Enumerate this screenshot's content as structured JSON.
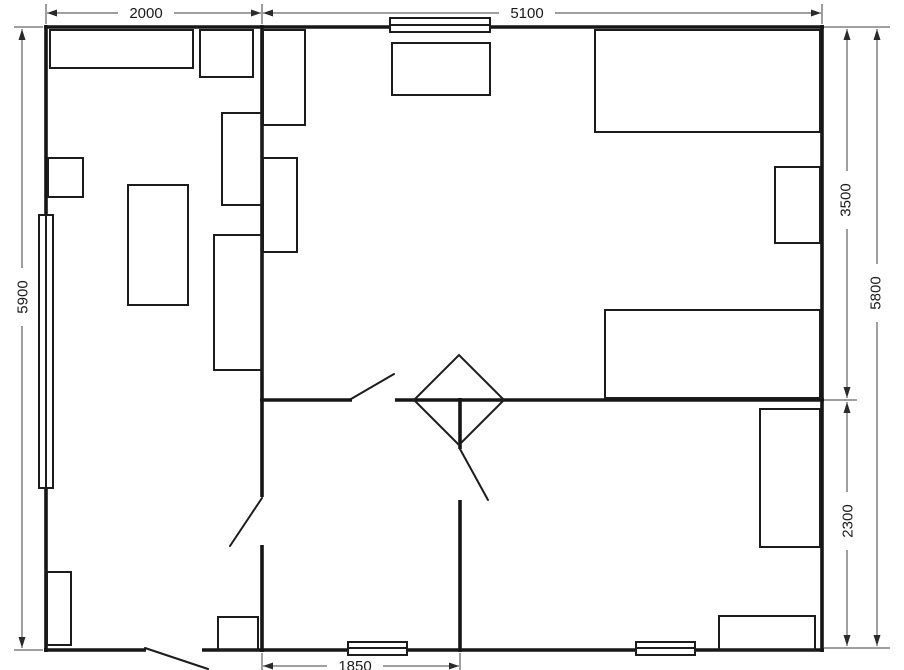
{
  "plan": {
    "dimensions": {
      "top_left": "2000",
      "top_right": "5100",
      "left_total": "5900",
      "right_upper": "3500",
      "right_lower": "2300",
      "right_total": "5800",
      "bottom_hall": "1850"
    },
    "colors": {
      "background": "#ffffff",
      "wall": "#161616",
      "furniture_line": "#1c1c1c",
      "dimension_line": "#3f3f3f",
      "label_text": "#1a1a1a"
    }
  }
}
